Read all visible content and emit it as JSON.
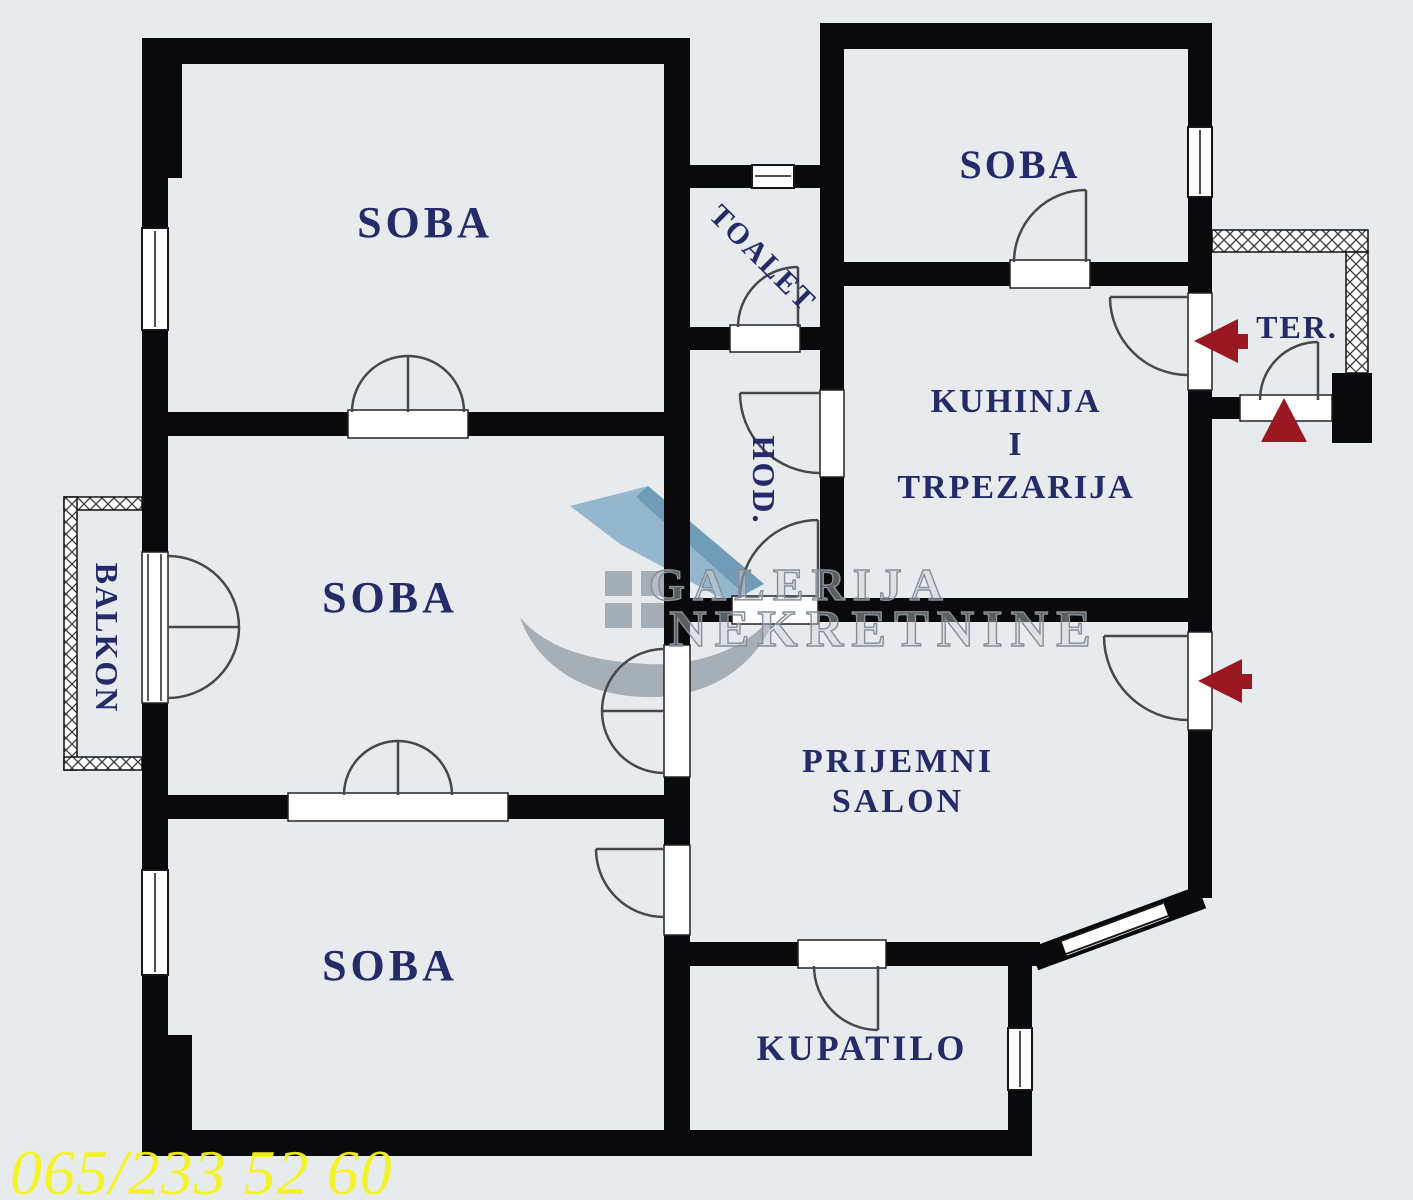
{
  "colors": {
    "background": "#e8ebee",
    "wall": "#0a0a0c",
    "door_line": "#46484c",
    "label": "#252a68",
    "arrow": "#9b1722",
    "phone": "#f4f41e",
    "watermark_gray": "#9aa3ac",
    "watermark_blue": "#86aec9"
  },
  "rooms": {
    "soba_top_left": {
      "label": "SOBA"
    },
    "soba_top_right": {
      "label": "SOBA"
    },
    "soba_middle": {
      "label": "SOBA"
    },
    "soba_bottom": {
      "label": "SOBA"
    },
    "toalet": {
      "label": "TOALET"
    },
    "hodnik": {
      "label": "HOD."
    },
    "kuhinja": {
      "line1": "KUHINJA",
      "line2": "I",
      "line3": "TRPEZARIJA"
    },
    "prijemni_salon": {
      "line1": "PRIJEMNI",
      "line2": "SALON"
    },
    "kupatilo": {
      "label": "KUPATILO"
    },
    "balkon": {
      "label": "BALKON"
    },
    "terasa": {
      "label": "TER."
    }
  },
  "watermark": {
    "line1": "GALERIJA",
    "line2": "NEKRETNINE"
  },
  "footer": {
    "phone": "065/233 52 60"
  }
}
